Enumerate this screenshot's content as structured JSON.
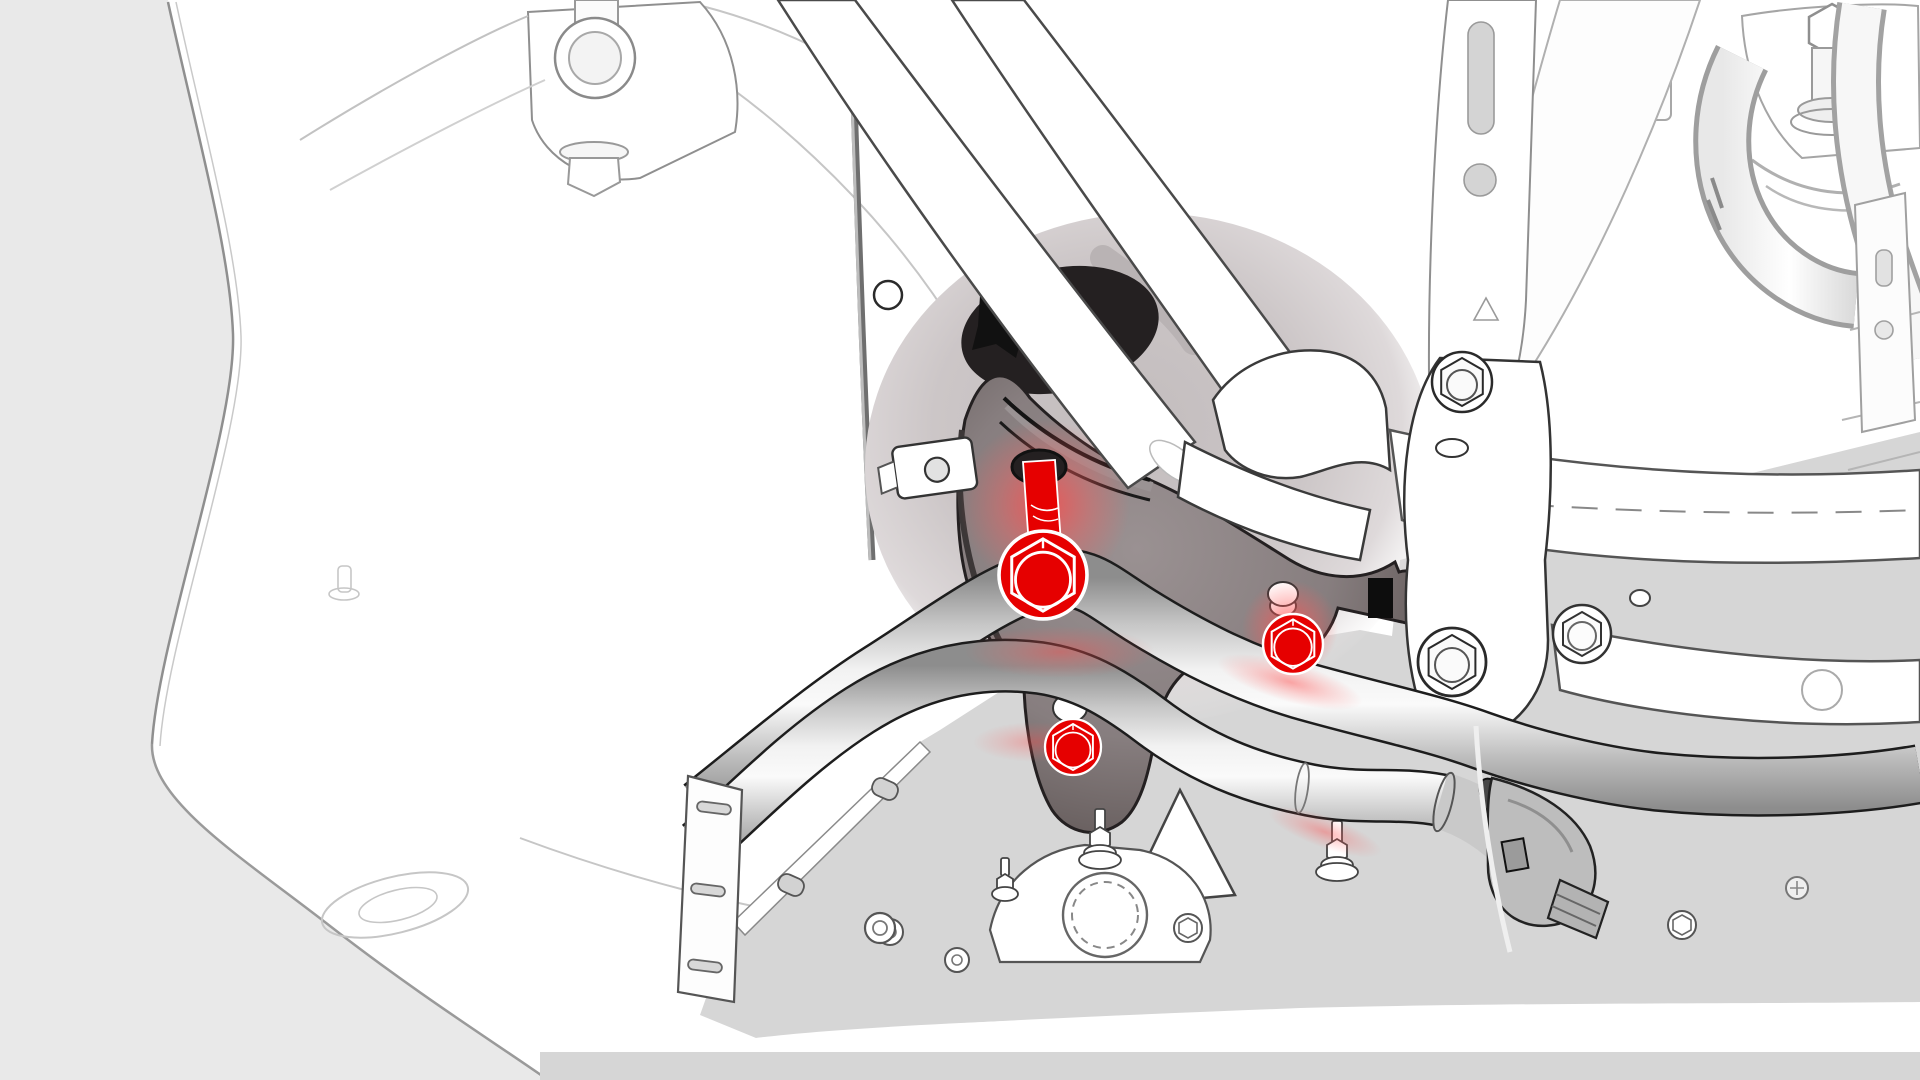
{
  "figure": {
    "kind": "technical-illustration",
    "description": "Vehicle front underbody wheel-well view with coolant pipe bracket fasteners highlighted in red",
    "highlight_count": 3
  },
  "colors": {
    "background": "#e9e9e9",
    "artwork_white": "#ffffff",
    "line_dark": "#1f1f1f",
    "line_mid": "#555555",
    "line_faint": "#c6c6c6",
    "floor_gray": "#d6d6d6",
    "cavity_gray": "#c9c3c4",
    "bracket_face": "#8e8485",
    "bracket_edge": "#554c4b",
    "hole_dark": "#242021",
    "pipe_light": "#f2f2f2",
    "pipe_mid": "#c6c6c6",
    "pipe_dark": "#8d8d8d",
    "highlight_red": "#e60000",
    "glow_red": "#ff5a5a",
    "fitting_gray": "#bdbdbd"
  },
  "fasteners": [
    {
      "id": "bolt-bracket-main",
      "type": "hex-flange-bolt-with-shaft",
      "cx": 1043,
      "cy": 575,
      "r": 44,
      "transform": "translate(1043,575) scale(1.571)"
    },
    {
      "id": "bolt-bracket-right",
      "type": "hex-flange-bolt",
      "cx": 1293,
      "cy": 644,
      "r": 30,
      "transform": "translate(1293,644) scale(1.071)"
    },
    {
      "id": "bolt-bracket-lower",
      "type": "hex-flange-bolt",
      "cx": 1073,
      "cy": 747,
      "r": 28,
      "transform": "translate(1073,747) scale(1)"
    }
  ]
}
